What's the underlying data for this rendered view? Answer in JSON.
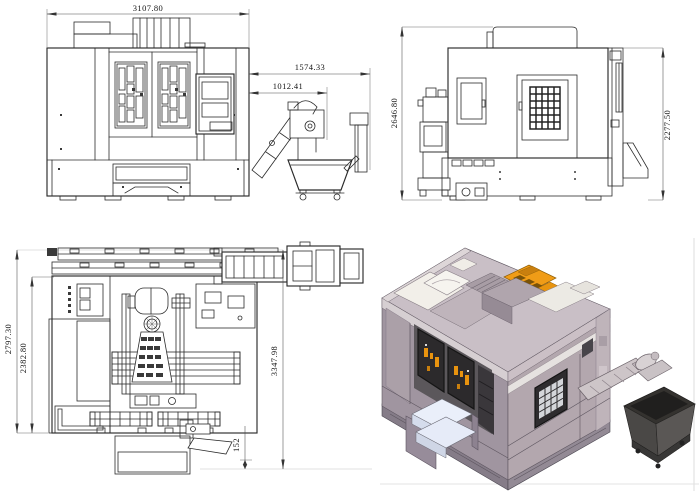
{
  "dimensions": {
    "front_overall_width": "3107.80",
    "front_conveyor_overall": "1574.33",
    "front_conveyor_discharge": "1012.41",
    "side_overall_height": "2646.80",
    "side_body_height": "2277.50",
    "top_overall_depth": "2797.30",
    "top_body_depth": "2382.80",
    "top_depth_with_conveyor": "3347.98",
    "top_service_offset": "152"
  },
  "colors": {
    "line": "#2b2b2b",
    "dimension_line": "#4a4a4a",
    "background": "#ffffff",
    "iso_roof": "#c9bfc6",
    "iso_front_face": "#a095a0",
    "iso_right_face": "#b3a7ae",
    "iso_panel_white": "#f2efe9",
    "iso_accent_orange": "#f09c17",
    "iso_window_dark": "#2c2a2c",
    "iso_steps_blue": "#eaeffa",
    "iso_hopper_gray": "#4a4846",
    "iso_base_dark": "#857c88"
  }
}
